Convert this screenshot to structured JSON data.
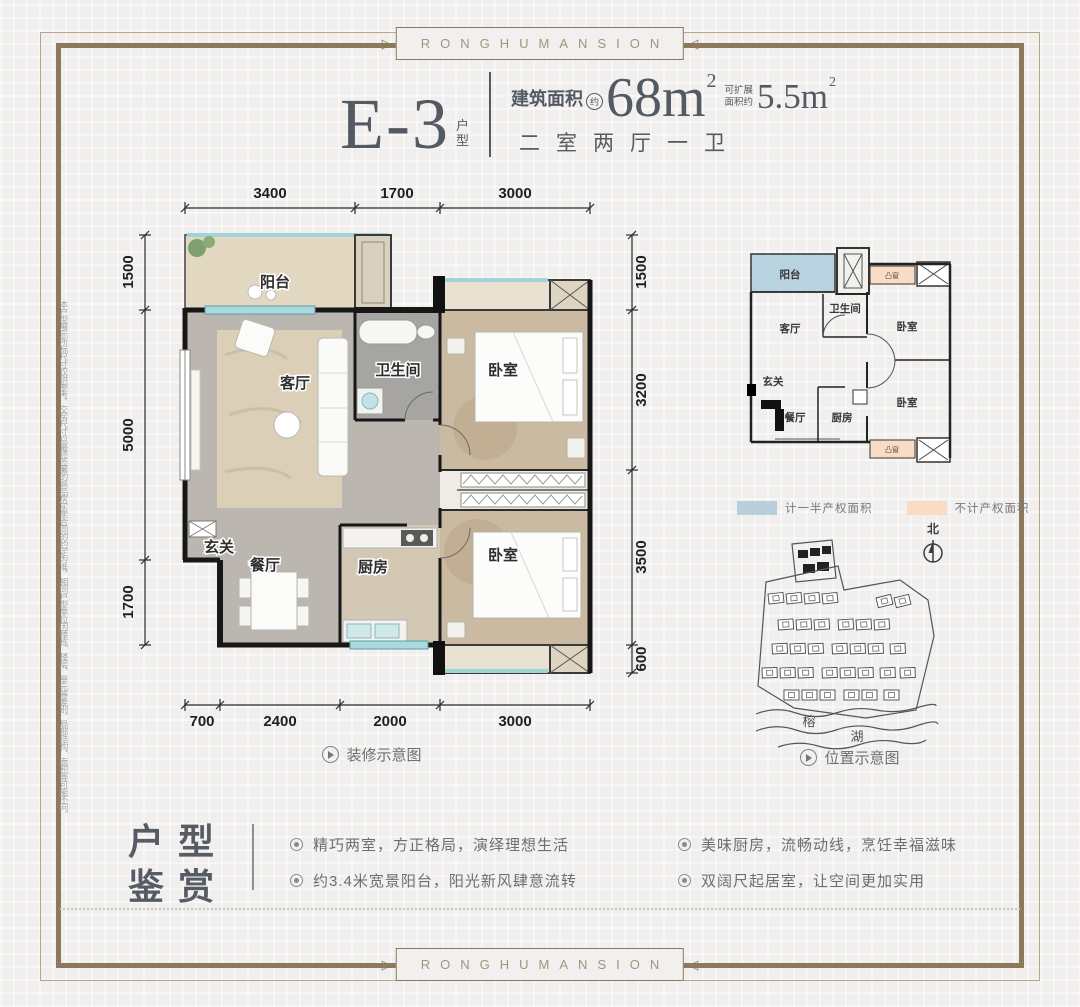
{
  "frame": {
    "brand_top": "RONGHUMANSION",
    "brand_bottom": "RONGHUMANSION"
  },
  "disclaimer": "本户型展示所标尺寸仅供参考，交房尺寸以最终签署的商品房买卖合同的约定为准，相同户型单位因楼栋、楼层、单元等差别，局部结构、面积等可能不同。",
  "header": {
    "unit_code": "E-3",
    "unit_code_suffix": "户型",
    "area_label": "建筑面积",
    "area_approx_badge": "约",
    "area_value": "68m",
    "area_value_sup": "2",
    "expand_label_line1": "可扩展",
    "expand_label_line2": "面积约",
    "expand_value": "5.5m",
    "expand_value_sup": "2",
    "layout_text": "二室两厅一卫"
  },
  "main_plan": {
    "dims_top": [
      "3400",
      "1700",
      "3000"
    ],
    "dims_left": [
      "1500",
      "5000",
      "1700"
    ],
    "dims_right": [
      "1500",
      "3200",
      "3500",
      "600"
    ],
    "dims_bottom": [
      "700",
      "2400",
      "2000",
      "3000"
    ],
    "rooms": {
      "balcony": "阳台",
      "living": "客厅",
      "bathroom": "卫生间",
      "bedroom_top": "卧室",
      "bedroom_bottom": "卧室",
      "entry": "玄关",
      "dining": "餐厅",
      "kitchen": "厨房"
    },
    "caption": "装修示意图"
  },
  "schematic": {
    "rooms": {
      "balcony": "阳台",
      "living": "客厅",
      "bathroom": "卫生间",
      "bedroom_top": "卧室",
      "bedroom_bottom": "卧室",
      "entry": "玄关",
      "dining": "餐厅",
      "kitchen": "厨房",
      "bay_top": "凸窗",
      "bay_bottom": "凸窗"
    },
    "legend": [
      {
        "color": "#b9cfdc",
        "label": "计一半产权面积"
      },
      {
        "color": "#f8dcc5",
        "label": "不计产权面积"
      }
    ]
  },
  "sitemap": {
    "north_label": "北",
    "lake_label_1": "榕",
    "lake_label_2": "湖",
    "caption": "位置示意图"
  },
  "features": {
    "title_line1": "户型",
    "title_line2": "鉴赏",
    "bullets": [
      "精巧两室，方正格局，演绎理想生活",
      "约3.4米宽景阳台，阳光新风肆意流转",
      "美味厨房，流畅动线，烹饪幸福滋味",
      "双阔尺起居室，让空间更加实用"
    ]
  },
  "colors": {
    "accent_brown": "#8d7a5c",
    "title_gray": "#545a63",
    "legend_blue": "#b9cfdc",
    "legend_peach": "#f8dcc5"
  }
}
